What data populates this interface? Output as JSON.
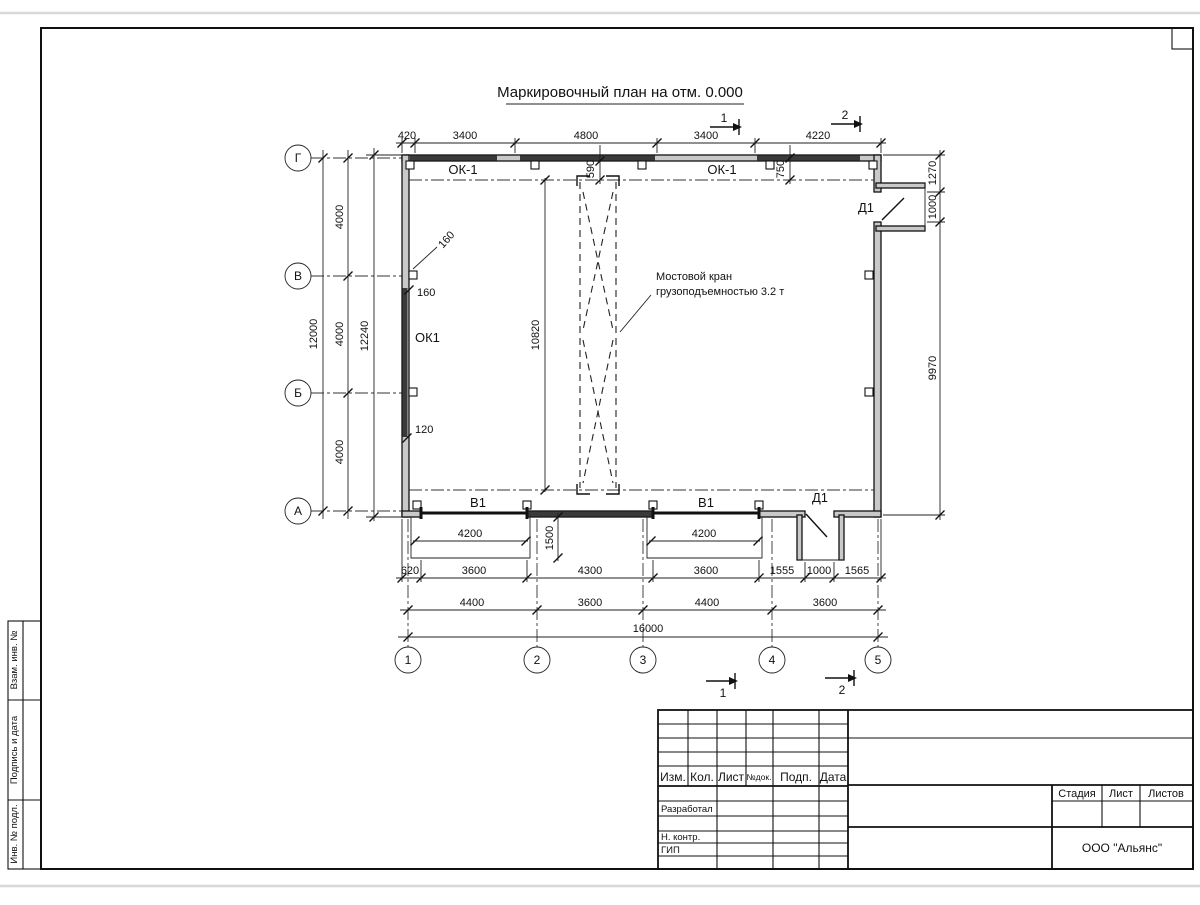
{
  "title": "Маркировочный план на отм. 0.000",
  "grid": {
    "rows": [
      "Г",
      "В",
      "Б",
      "А"
    ],
    "cols": [
      "1",
      "2",
      "3",
      "4",
      "5"
    ]
  },
  "dims": {
    "top": [
      "420",
      "3400",
      "4800",
      "3400",
      "4220"
    ],
    "left_bays": [
      "4000",
      "4000",
      "4000"
    ],
    "left_total": "12000",
    "left_overall": "12240",
    "rail_offset_left": "590",
    "rail_offset_right": "750",
    "crane_length": "10820",
    "right": [
      "1270",
      "1000",
      "9970"
    ],
    "gate_clear": [
      "4200",
      "4200"
    ],
    "ramp_depth": "1500",
    "bottom_row1": [
      "620",
      "3600",
      "4300",
      "3600",
      "1555",
      "1000",
      "1565"
    ],
    "bottom_row2": [
      "4400",
      "3600",
      "4400",
      "3600"
    ],
    "bottom_total": "16000",
    "wall_mark_160a": "160",
    "wall_mark_160b": "160",
    "wall_mark_120": "120"
  },
  "marks": {
    "window_top_left": "ОК-1",
    "window_top_right": "ОК-1",
    "window_left": "ОК1",
    "door_right": "Д1",
    "door_bottom": "Д1",
    "gate_left": "В1",
    "gate_right": "В1"
  },
  "notes": {
    "crane_line1": "Мостовой кран",
    "crane_line2": "грузоподъемностью 3.2 т"
  },
  "sections": {
    "top1": "1",
    "top2": "2",
    "bottom1": "1",
    "bottom2": "2"
  },
  "titleblock": {
    "header": [
      "Изм.",
      "Кол.",
      "Лист",
      "№док.",
      "Подп.",
      "Дата"
    ],
    "roles": [
      "Разработал",
      "Н. контр.",
      "ГИП"
    ],
    "stage_header": [
      "Стадия",
      "Лист",
      "Листов"
    ],
    "org": "ООО \"Альянс\""
  },
  "margin_strip": [
    "Взам. инв. №",
    "Подпись и дата",
    "Инв. № подл."
  ]
}
